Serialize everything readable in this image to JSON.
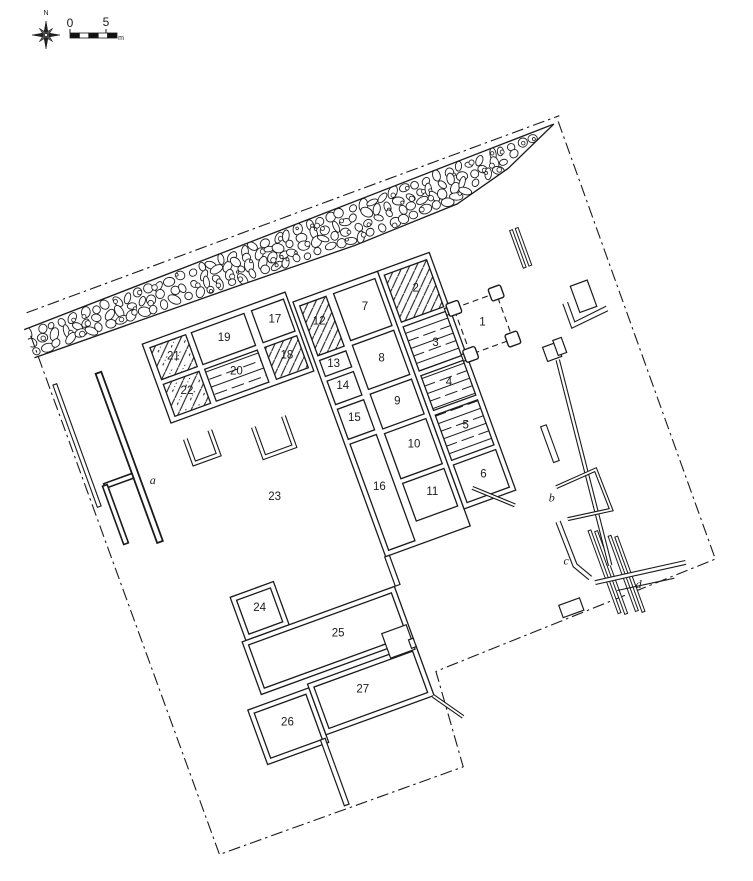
{
  "title": "archaeological-site-plan",
  "colors": {
    "ink": "#1a1a1a",
    "bg": "#ffffff"
  },
  "compass": {
    "label": "N"
  },
  "scale_bar": {
    "start": "0",
    "end": "5",
    "unit": "m"
  },
  "plan": {
    "rotation_deg": -20,
    "room_labels": [
      {
        "text": "1",
        "u": 342,
        "v": 471
      },
      {
        "text": "2",
        "u": 291,
        "v": 416
      },
      {
        "text": "3",
        "u": 291,
        "v": 474
      },
      {
        "text": "4",
        "u": 290,
        "v": 516
      },
      {
        "text": "5",
        "u": 291,
        "v": 562
      },
      {
        "text": "6",
        "u": 291,
        "v": 614
      },
      {
        "text": "7",
        "u": 237,
        "v": 416
      },
      {
        "text": "8",
        "u": 235,
        "v": 470
      },
      {
        "text": "9",
        "u": 235,
        "v": 516
      },
      {
        "text": "10",
        "u": 236,
        "v": 562
      },
      {
        "text": "11",
        "u": 237,
        "v": 613
      },
      {
        "text": "12",
        "u": 189,
        "v": 414
      },
      {
        "text": "13",
        "u": 188,
        "v": 459
      },
      {
        "text": "14",
        "u": 189,
        "v": 483
      },
      {
        "text": "15",
        "u": 189,
        "v": 517
      },
      {
        "text": "16",
        "u": 189,
        "v": 590
      },
      {
        "text": "17",
        "u": 148,
        "v": 397
      },
      {
        "text": "18",
        "u": 147,
        "v": 435
      },
      {
        "text": "19",
        "u": 94,
        "v": 397
      },
      {
        "text": "20",
        "u": 94,
        "v": 433
      },
      {
        "text": "21",
        "u": 40,
        "v": 397
      },
      {
        "text": "22",
        "u": 41,
        "v": 434
      },
      {
        "text": "23",
        "u": 87,
        "v": 564
      },
      {
        "text": "24",
        "u": 35,
        "v": 663
      },
      {
        "text": "25",
        "u": 100,
        "v": 714
      },
      {
        "text": "26",
        "u": 22,
        "v": 780
      },
      {
        "text": "27",
        "u": 104,
        "v": 775
      }
    ],
    "feature_labels": [
      {
        "text": "a",
        "u": -22,
        "v": 507
      },
      {
        "text": "b",
        "u": 347,
        "v": 660
      },
      {
        "text": "c",
        "u": 339,
        "v": 724
      },
      {
        "text": "d",
        "u": 399,
        "v": 771
      }
    ]
  }
}
